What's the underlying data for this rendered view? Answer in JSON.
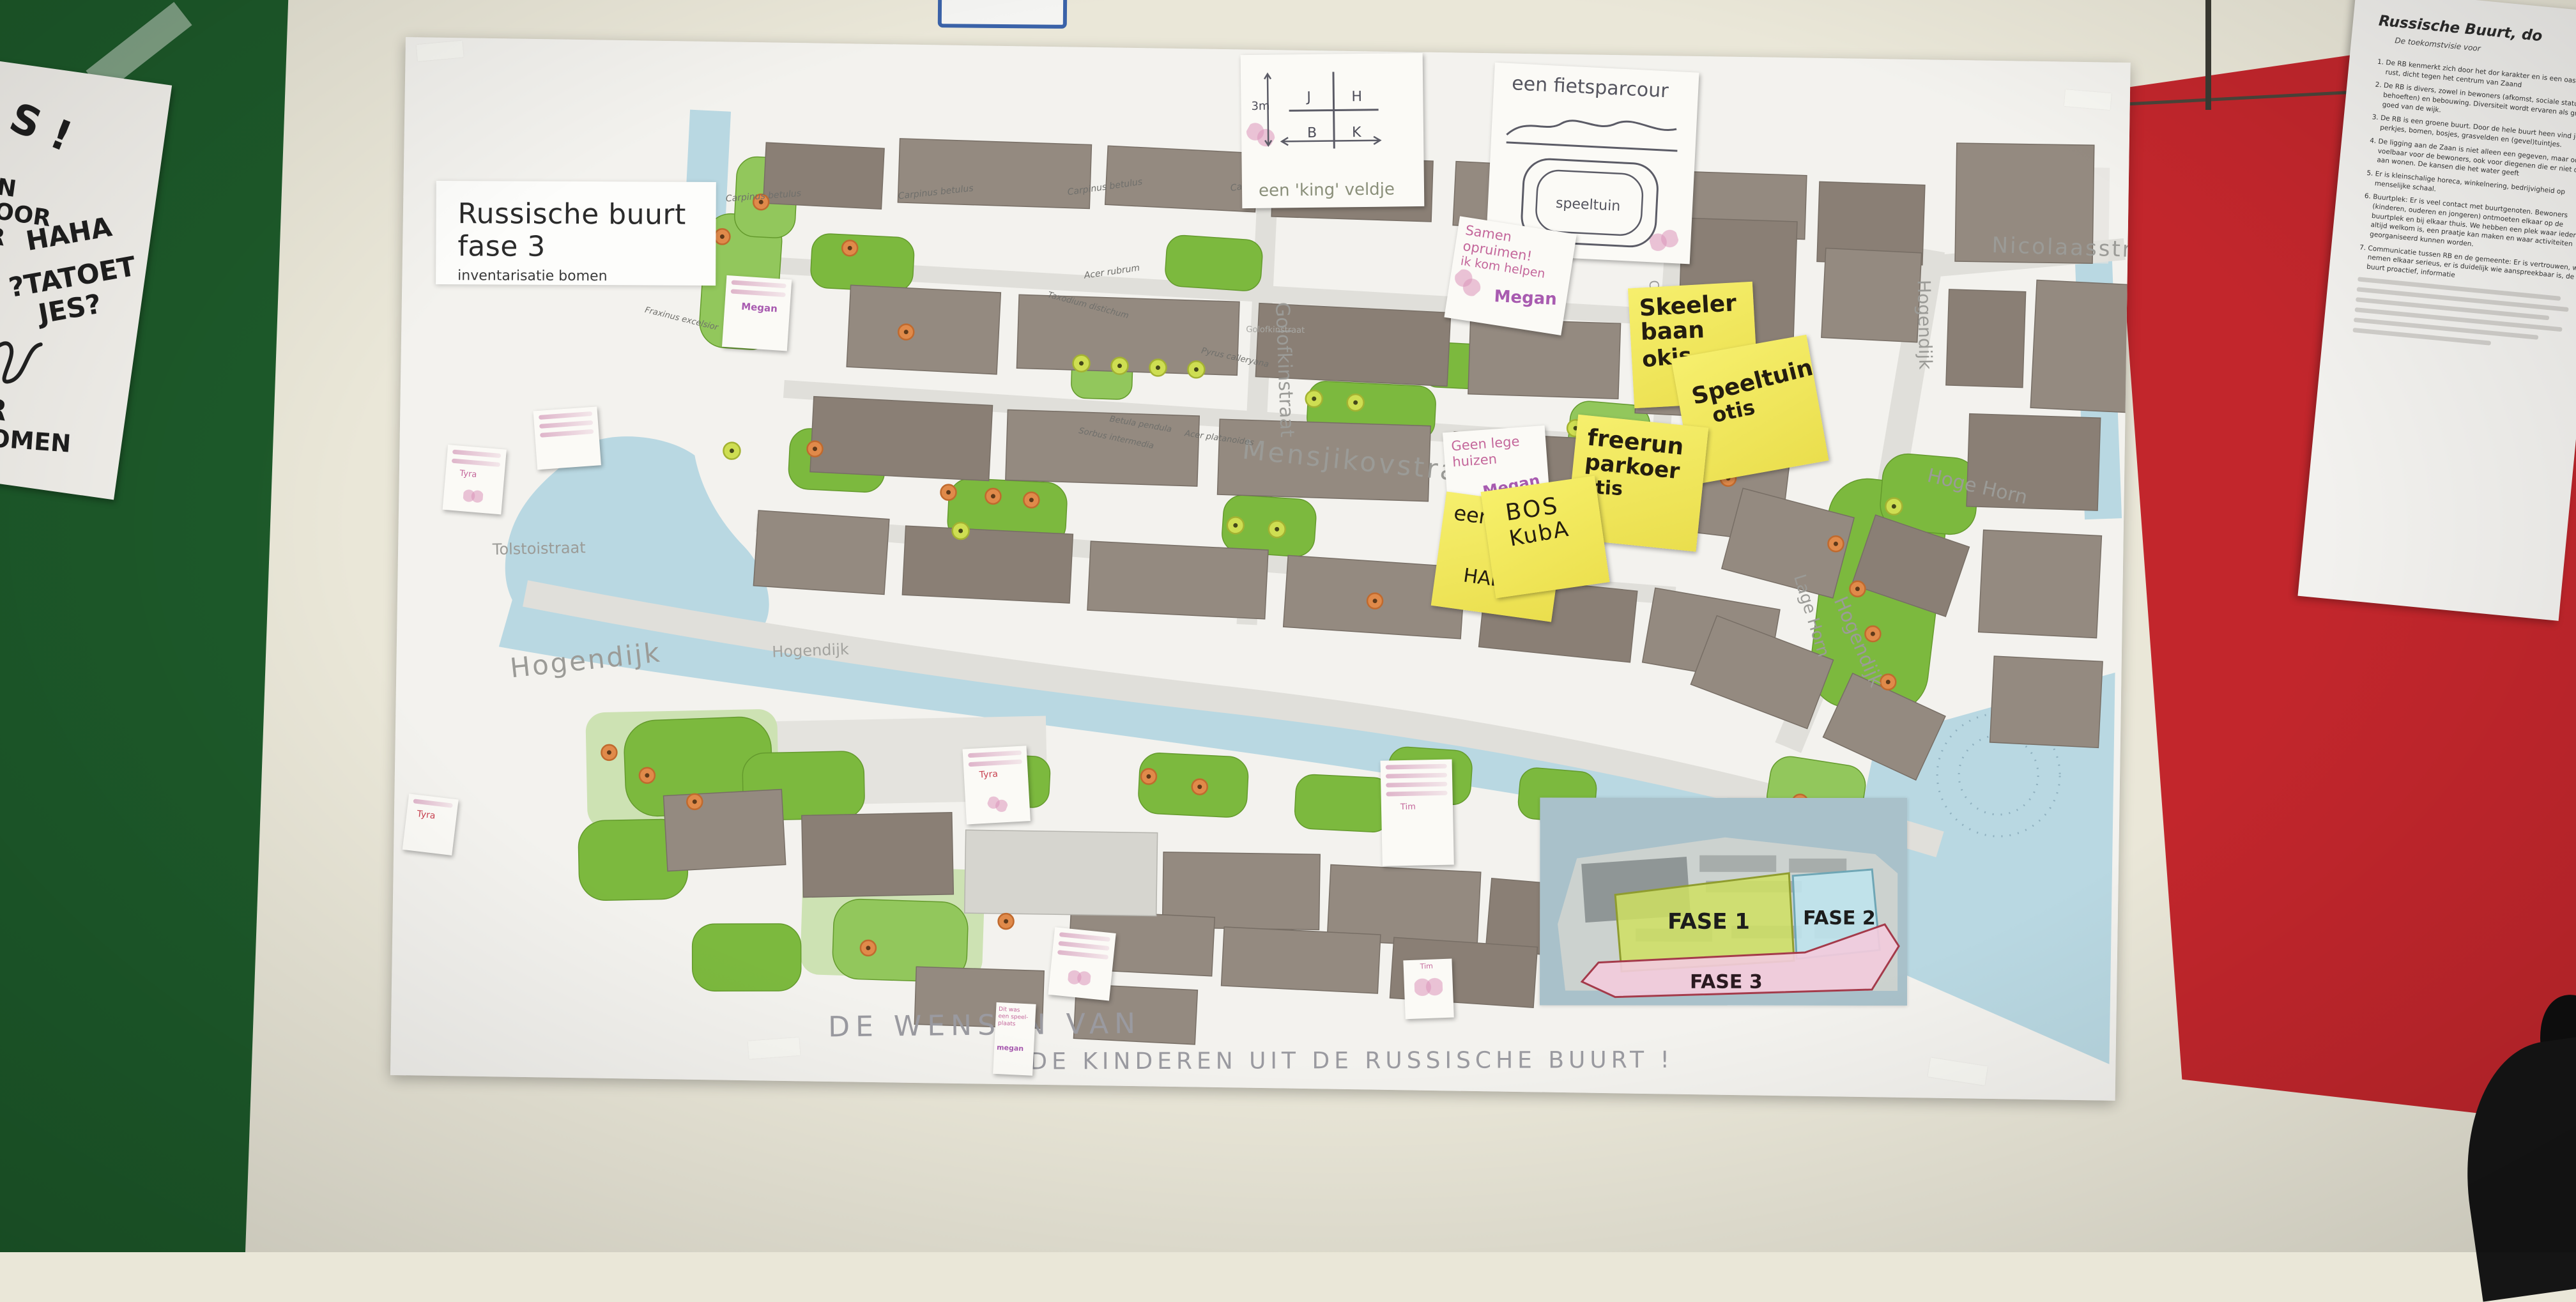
{
  "photo": {
    "wall_green_color": "#1d5a2a",
    "wall_red_color": "#c2262c",
    "wall_cream_color": "#eae7d8"
  },
  "left_paper": {
    "fragments": {
      "f1": "S !",
      "f2": "N",
      "f3": "VOOR",
      "f4": "AR",
      "f5": "HAHA",
      "f6": "?TATOET",
      "f7": "JES?",
      "f8": "S.",
      "f9": "AAR",
      "f10": "GEKOMEN"
    }
  },
  "poster": {
    "title": "Russische buurt fase 3",
    "subtitle": "inventarisatie bomen",
    "caption_left": "DE  WENSEN  VAN",
    "caption_right": "DE  KINDEREN  UIT  DE  RUSSISCHE  BUURT !",
    "streets": {
      "nicolaasstr": "Nicolaasstr",
      "hogendijk": "Hogendijk",
      "hoge_horn": "Hoge Horn",
      "lage_horn": "Lage Horn",
      "golofkinstraat": "Golofkinstraat",
      "cornelis_calffstraat": "Cornelis Calffstraat",
      "mensjikovstraat": "Mensjikovstraat",
      "tolstoistraat": "Tolstoistraat"
    },
    "species": {
      "carpinus": "Carpinus betulus",
      "acer_rubrum": "Acer rubrum",
      "taxodium": "Taxodium distichum",
      "pyrus": "Pyrus calleryana",
      "betula": "Betula pendula",
      "acer_plat": "Acer platanoides",
      "sorbus": "Sorbus intermedia",
      "fraxinus": "Fraxinus excelsior"
    },
    "inset": {
      "fase1": "FASE 1",
      "fase2": "FASE 2",
      "fase3": "FASE 3"
    }
  },
  "notes": {
    "king": {
      "caption": "een 'king' veldje",
      "letters": [
        "J",
        "H",
        "B",
        "K"
      ],
      "measure": "3m"
    },
    "fiets": {
      "title": "een fietsparcour",
      "label": "speeltuin"
    },
    "samen": {
      "lines": [
        "Samen",
        "opruimen!",
        "ik kom helpen"
      ],
      "signature": "Megan"
    },
    "lege": {
      "lines": [
        "Geen lege",
        "huizen"
      ],
      "signature": "Megan"
    },
    "skeeler": {
      "lines": [
        "Skeeler",
        "baan",
        "okis"
      ]
    },
    "speeltuin": {
      "lines": [
        "Speeltuin",
        "otis"
      ]
    },
    "freerun": {
      "lines": [
        "freerun",
        "parkoer",
        "otis"
      ]
    },
    "een_hallo": {
      "lines": [
        "een",
        "HALLO"
      ]
    },
    "bos": {
      "lines": [
        "BOS",
        "KubA"
      ]
    },
    "ditwas": {
      "lines": [
        "Dit was",
        "een speel-",
        "plaats"
      ],
      "signature": "megan"
    },
    "tim": {
      "signature": "Tim"
    },
    "tyra": {
      "signature": "Tyra"
    }
  },
  "right_paper": {
    "title": "Russische Buurt, do",
    "subtitle": "De toekomstvisie voor",
    "items": [
      "1.  De RB kenmerkt zich door het dor karakter en is een oase van rust, dicht tegen het centrum van Zaand",
      "2.  De RB is divers, zowel in bewoners (afkomst, sociale status, behoeften) en bebouwing. Diversiteit wordt ervaren als groot goed van de wijk.",
      "3.  De RB is een groene buurt. Door de hele buurt heen vind je perkjes, bomen, bosjes, grasvelden en (gevel)tuintjes.",
      "4.  De ligging aan de Zaan is niet alleen een gegeven, maar ook voelbaar voor de bewoners, ook voor diegenen die er niet direct aan wonen. De kansen die het water geeft",
      "5.  Er is kleinschalige horeca, winkelnering, bedrijvigheid op menselijke schaal.",
      "6.  Buurtplek: Er is veel contact met buurtgenoten. Bewoners (kinderen, ouderen en jongeren) ontmoeten elkaar op de buurtplek en bij elkaar thuis. We hebben een plek waar iedereen altijd welkom is, een praatje kan maken en waar activiteiten georganiseerd kunnen worden.",
      "7.  Communicatie tussen RB en de gemeente: Er is vertrouwen, we nemen elkaar serieus, er is duidelijk wie aanspreekbaar is, de buurt proactief, informatie"
    ]
  }
}
